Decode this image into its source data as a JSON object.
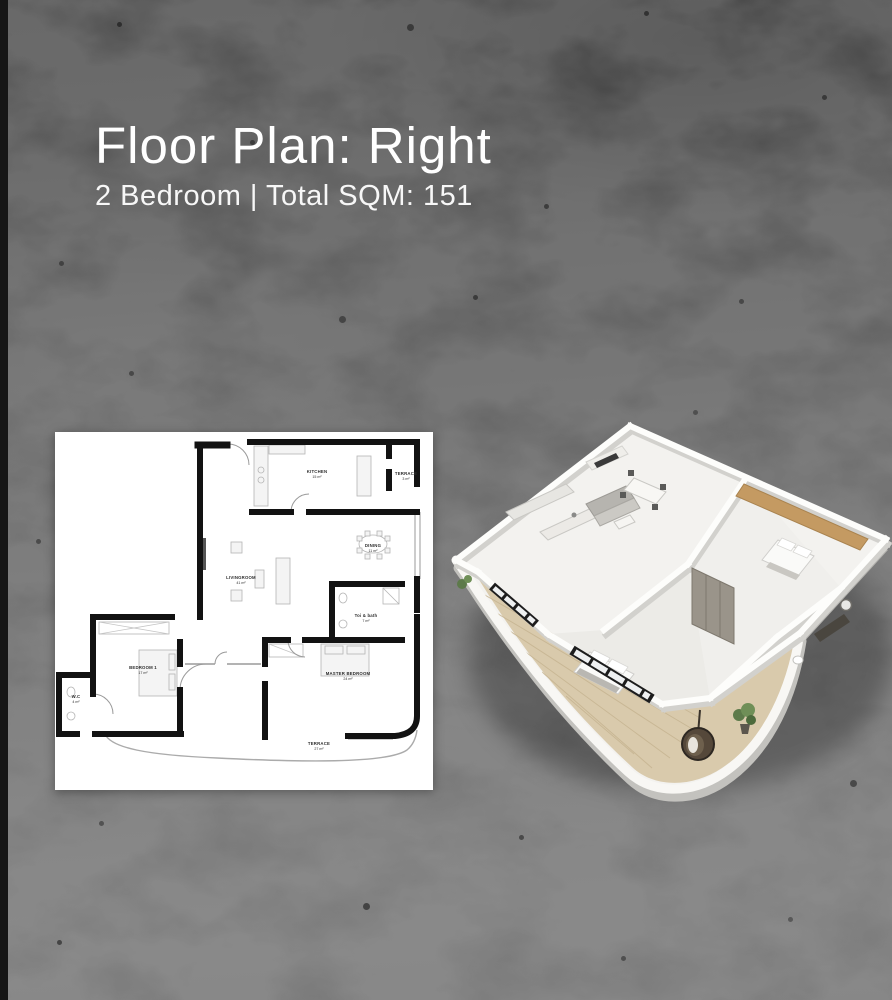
{
  "page": {
    "title": "Floor Plan: Right",
    "subtitle": "2 Bedroom | Total SQM: 151"
  },
  "plan2d": {
    "rooms": [
      {
        "id": "kitchen",
        "name": "KITCHEN",
        "area": "15 m²"
      },
      {
        "id": "terrace-top",
        "name": "TERRACE",
        "area": "3 m²"
      },
      {
        "id": "dining",
        "name": "DINING",
        "area": "11 m²"
      },
      {
        "id": "livingroom",
        "name": "LIVINGROOM",
        "area": "41 m²"
      },
      {
        "id": "toi-bath",
        "name": "Toi & bath",
        "area": "7 m²"
      },
      {
        "id": "bedroom-1",
        "name": "BEDROOM 1",
        "area": "17 m²"
      },
      {
        "id": "master-bedroom",
        "name": "MASTER BEDROOM",
        "area": "24 m²"
      },
      {
        "id": "terrace-bottom",
        "name": "TERRACE",
        "area": "27 m²"
      },
      {
        "id": "wc",
        "name": "W.C",
        "area": "4 m²"
      }
    ]
  },
  "colors": {
    "background_base": "#4a4a4a",
    "edge_strip": "#161616",
    "title_text": "#ffffff",
    "plan_paper": "#ffffff",
    "plan_walls": "#121212",
    "render_slab": "#f3f2ef",
    "render_wood_floor": "#d9caac",
    "render_accent_wood": "#c49a62"
  }
}
